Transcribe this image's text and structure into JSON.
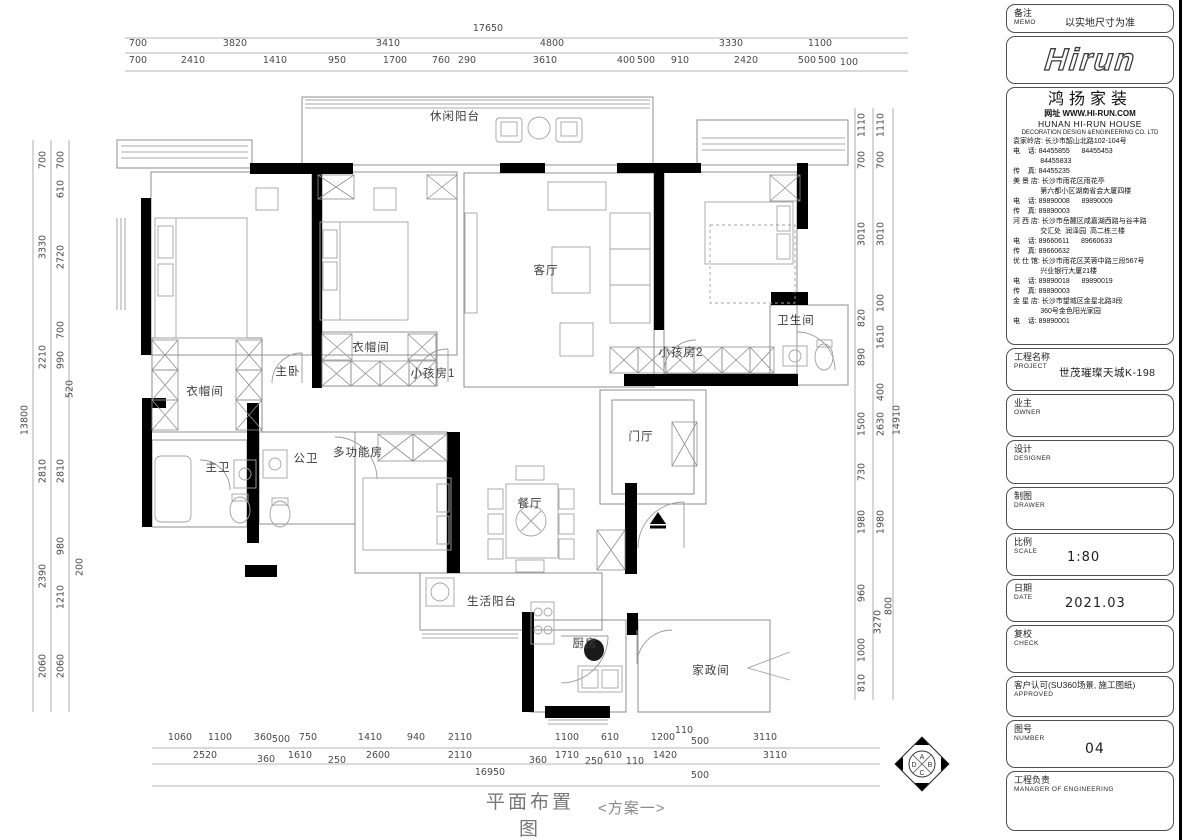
{
  "titleblock": {
    "memo": {
      "zh": "备注",
      "en": "MEMO",
      "value": "以实地尺寸为准"
    },
    "logo": "Hirun",
    "company": {
      "name": "鸿扬家装",
      "website": "网址 WWW.HI-RUN.COM",
      "name_en": "HUNAN  HI-RUN  HOUSE",
      "name_en2": "DECORATION  DESIGN  &ENGINEERING  CO.  LTD",
      "lines": [
        "袁家岭店: 长沙市韶山北路102-104号",
        "电    话: 84455855      84455453",
        "              84455833",
        "传    真: 84455235",
        "美 景 店: 长沙市雨花区雨花亭",
        "              第六都小区湖南省会大厦四楼",
        "电    话: 89890008      89890009",
        "传    真: 89890003",
        "河 西 店: 长沙市岳麓区咸嘉湖西路与谷丰路",
        "              交汇处  润泽园  高二栋三楼",
        "电    话: 89660611      89660633",
        "传    真: 89660632",
        "优 仕 馆: 长沙市雨花区芙蓉中路三段567号",
        "              兴业银行大厦21楼",
        "电    话: 89890018      89890019",
        "传    真: 89890003",
        "金 星 店: 长沙市望城区金星北路3段",
        "              360号金色阳光家园",
        "电    话: 89890001"
      ]
    },
    "fields": [
      {
        "zh": "工程名称",
        "en": "PROJECT",
        "value": "世茂璀璨天城K-198"
      },
      {
        "zh": "业主",
        "en": "OWNER",
        "value": ""
      },
      {
        "zh": "设计",
        "en": "DESIGNER",
        "value": ""
      },
      {
        "zh": "制图",
        "en": "DRAWER",
        "value": ""
      },
      {
        "zh": "比例",
        "en": "SCALE",
        "value": "1:80"
      },
      {
        "zh": "日期",
        "en": "DATE",
        "value": "2021.03"
      },
      {
        "zh": "复校",
        "en": "CHECK",
        "value": ""
      },
      {
        "zh": "客户认可(SU360场景, 施工图纸)",
        "en": "APPROVED",
        "value": ""
      },
      {
        "zh": "图号",
        "en": "NUMBER",
        "value": "04"
      },
      {
        "zh": "工程负责",
        "en": "MANAGER OF ENGINEERING",
        "value": ""
      }
    ]
  },
  "plan": {
    "labels": [
      "休闲阳台",
      "客厅",
      "主卧",
      "衣帽间",
      "小孩房1",
      "小孩房2",
      "卫生间",
      "衣帽间",
      "主卫",
      "公卫",
      "多功能房",
      "门厅",
      "餐厅",
      "生活阳台",
      "厨房",
      "家政间"
    ]
  },
  "dims": {
    "top_overall": "17650",
    "top_row1": [
      "700",
      "3820",
      "3410",
      "4800",
      "3330",
      "1100"
    ],
    "top_row2": [
      "700",
      "2410",
      "1410",
      "950",
      "1700",
      "760",
      "290",
      "3610",
      "400",
      "500",
      "910",
      "2420",
      "500",
      "500",
      "100"
    ],
    "bottom_row1": [
      "1060",
      "1100",
      "360",
      "500",
      "750",
      "1410",
      "940",
      "2110",
      "1100",
      "610",
      "1200",
      "110",
      "500",
      "3110"
    ],
    "bottom_row2": [
      "2520",
      "360",
      "1610",
      "250",
      "2600",
      "2110",
      "360",
      "1710",
      "250",
      "610",
      "110",
      "1420",
      "3110"
    ],
    "bottom_overall": [
      "16950",
      "500"
    ],
    "left_overall": "13800",
    "left_col1": [
      "700",
      "3330",
      "2210",
      "2810",
      "2390",
      "2060"
    ],
    "left_col2": [
      "700",
      "610",
      "2720",
      "700",
      "990",
      "520",
      "2810",
      "980",
      "200",
      "1210",
      "2060"
    ],
    "right_overall": "14910",
    "right_col1": [
      "1110",
      "700",
      "3010",
      "820",
      "890",
      "1500",
      "730",
      "1980",
      "960",
      "1000",
      "810"
    ],
    "right_col2": [
      "1110",
      "700",
      "3010",
      "100",
      "1610",
      "400",
      "2630",
      "1980",
      "3270",
      "800"
    ]
  },
  "compass": {
    "n": "A",
    "e": "B",
    "s": "C",
    "w": "D"
  },
  "footer": {
    "title": "平面布置图",
    "scheme": "<方案一>"
  }
}
